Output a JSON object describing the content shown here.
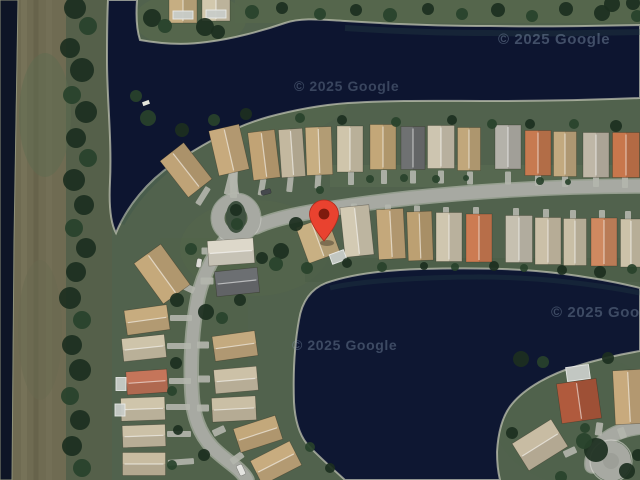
{
  "map": {
    "view_type": "satellite",
    "attribution": "© 2025 Google",
    "pin": {
      "label": "dropped-pin",
      "color": "#e9422f",
      "inner_color": "#7e1b0e",
      "x": 324,
      "y": 241
    },
    "colors": {
      "water": "#0d1530",
      "land": "#51624d",
      "road": "#a7a9a2",
      "shoreline": "#c8cbb8",
      "tree_dark": "#1c2f20",
      "tree_mid": "#28422b",
      "tree_light": "#355033",
      "bank_brown": "#6f6b52"
    }
  },
  "houses": [
    [
      186,
      170,
      30,
      46,
      -38,
      "#bfa377"
    ],
    [
      229,
      150,
      31,
      46,
      -13,
      "#c7aa7d"
    ],
    [
      264,
      155,
      27,
      48,
      -7,
      "#c1a375"
    ],
    [
      292,
      153,
      24,
      48,
      -4,
      "#c3b89f"
    ],
    [
      319,
      151,
      26,
      48,
      -2,
      "#c7ae82"
    ],
    [
      350,
      149,
      26,
      46,
      0,
      "#cfc5ab"
    ],
    [
      383,
      147,
      26,
      45,
      0,
      "#c3a778"
    ],
    [
      413,
      148,
      24,
      43,
      0,
      "#6f7172"
    ],
    [
      441,
      147,
      27,
      43,
      0,
      "#cdc5b0"
    ],
    [
      469,
      149,
      23,
      43,
      0,
      "#c1a77b"
    ],
    [
      508,
      147,
      26,
      44,
      0,
      "#b4b2aa"
    ],
    [
      538,
      153,
      26,
      45,
      0,
      "#c77a50"
    ],
    [
      565,
      154,
      23,
      45,
      0,
      "#c2a97f"
    ],
    [
      596,
      155,
      26,
      45,
      0,
      "#bfb7a7"
    ],
    [
      626,
      155,
      27,
      45,
      0,
      "#c8774c"
    ],
    [
      183,
      8,
      28,
      30,
      0,
      "#c6ae82"
    ],
    [
      216,
      7,
      28,
      28,
      0,
      "#d2c8ad"
    ],
    [
      318,
      240,
      33,
      38,
      -20,
      "#c8b083"
    ],
    [
      357,
      231,
      29,
      50,
      -6,
      "#d3cab3"
    ],
    [
      391,
      234,
      27,
      50,
      -3,
      "#c4a87b"
    ],
    [
      420,
      236,
      25,
      49,
      -2,
      "#bca072"
    ],
    [
      449,
      237,
      26,
      49,
      0,
      "#cfc6af"
    ],
    [
      479,
      238,
      26,
      48,
      0,
      "#cc7b52"
    ],
    [
      519,
      239,
      27,
      47,
      0,
      "#c6c0b0"
    ],
    [
      548,
      241,
      26,
      47,
      0,
      "#cbc0a8"
    ],
    [
      575,
      242,
      23,
      47,
      0,
      "#c9bfa6"
    ],
    [
      604,
      242,
      26,
      48,
      0,
      "#cf8960"
    ],
    [
      631,
      243,
      21,
      48,
      0,
      "#ccc2a9"
    ],
    [
      231,
      252,
      46,
      25,
      -4,
      "#ddd8ca"
    ],
    [
      237,
      282,
      43,
      25,
      -6,
      "#6c6f72"
    ],
    [
      235,
      346,
      43,
      25,
      -8,
      "#c4aa7f"
    ],
    [
      236,
      380,
      43,
      24,
      -5,
      "#ccc1a7"
    ],
    [
      234,
      409,
      44,
      24,
      -3,
      "#cabfa5"
    ],
    [
      258,
      434,
      44,
      25,
      -18,
      "#c3a87b"
    ],
    [
      276,
      463,
      44,
      27,
      -27,
      "#c8ac7f"
    ],
    [
      162,
      274,
      33,
      50,
      -36,
      "#c5a97b"
    ],
    [
      147,
      320,
      43,
      25,
      -8,
      "#c7ac7f"
    ],
    [
      144,
      348,
      43,
      23,
      -6,
      "#cec4aa"
    ],
    [
      147,
      382,
      41,
      23,
      -4,
      "#c5755a"
    ],
    [
      143,
      409,
      44,
      23,
      -2,
      "#cfc5ab"
    ],
    [
      144,
      436,
      43,
      22,
      -2,
      "#ccc1a7"
    ],
    [
      144,
      464,
      43,
      23,
      0,
      "#c8bca1"
    ],
    [
      579,
      401,
      40,
      40,
      -8,
      "#b05a3d"
    ],
    [
      629,
      397,
      30,
      54,
      -3,
      "#c8aa7d"
    ],
    [
      540,
      445,
      46,
      32,
      -32,
      "#c8bca3"
    ]
  ],
  "pools": [
    [
      183,
      15,
      20,
      8,
      0
    ],
    [
      216,
      14,
      20,
      8,
      0
    ],
    [
      578,
      373,
      23,
      14,
      -8
    ],
    [
      338,
      257,
      15,
      10,
      -20
    ],
    [
      121,
      384,
      10,
      13,
      0
    ],
    [
      120,
      410,
      10,
      12,
      0
    ]
  ],
  "driveways": [
    [
      351,
      178,
      6,
      14,
      0
    ],
    [
      384,
      177,
      6,
      14,
      0
    ],
    [
      413,
      177,
      6,
      13,
      0
    ],
    [
      441,
      177,
      6,
      13,
      0
    ],
    [
      470,
      178,
      6,
      13,
      0
    ],
    [
      508,
      178,
      6,
      13,
      0
    ],
    [
      538,
      180,
      6,
      12,
      0
    ],
    [
      565,
      181,
      6,
      12,
      0
    ],
    [
      596,
      181,
      6,
      12,
      0
    ],
    [
      625,
      182,
      6,
      12,
      0
    ],
    [
      318,
      181,
      6,
      15,
      4
    ],
    [
      290,
      184,
      6,
      16,
      6
    ],
    [
      262,
      187,
      6,
      17,
      10
    ],
    [
      230,
      183,
      7,
      24,
      14
    ],
    [
      203,
      196,
      6,
      20,
      32
    ],
    [
      234,
      182,
      7,
      32,
      2
    ],
    [
      354,
      209,
      6,
      11,
      0
    ],
    [
      388,
      210,
      6,
      11,
      0
    ],
    [
      417,
      211,
      6,
      11,
      0
    ],
    [
      446,
      212,
      6,
      10,
      0
    ],
    [
      476,
      212,
      6,
      10,
      0
    ],
    [
      516,
      213,
      6,
      10,
      0
    ],
    [
      546,
      214,
      6,
      10,
      0
    ],
    [
      573,
      215,
      6,
      10,
      0
    ],
    [
      602,
      215,
      6,
      10,
      0
    ],
    [
      628,
      216,
      6,
      10,
      0
    ],
    [
      317,
      212,
      7,
      13,
      -12
    ],
    [
      208,
      251,
      13,
      7,
      0
    ],
    [
      207,
      281,
      13,
      7,
      0
    ],
    [
      203,
      345,
      12,
      7,
      0
    ],
    [
      204,
      379,
      12,
      7,
      0
    ],
    [
      203,
      408,
      12,
      7,
      0
    ],
    [
      219,
      431,
      13,
      7,
      -25
    ],
    [
      237,
      458,
      14,
      7,
      -35
    ],
    [
      181,
      318,
      22,
      6,
      0
    ],
    [
      179,
      346,
      24,
      6,
      0
    ],
    [
      180,
      381,
      22,
      6,
      0
    ],
    [
      178,
      407,
      24,
      6,
      0
    ],
    [
      179,
      434,
      24,
      6,
      0
    ],
    [
      181,
      462,
      26,
      6,
      -4
    ],
    [
      186,
      287,
      18,
      7,
      25
    ],
    [
      599,
      429,
      7,
      13,
      8
    ],
    [
      570,
      452,
      13,
      7,
      -25
    ],
    [
      622,
      433,
      7,
      11,
      -20
    ]
  ],
  "trees": [
    [
      75,
      8,
      11,
      0
    ],
    [
      88,
      26,
      9,
      1
    ],
    [
      70,
      48,
      10,
      0
    ],
    [
      82,
      70,
      12,
      0
    ],
    [
      72,
      95,
      9,
      1
    ],
    [
      86,
      112,
      11,
      0
    ],
    [
      76,
      138,
      10,
      0
    ],
    [
      88,
      158,
      9,
      1
    ],
    [
      74,
      180,
      11,
      0
    ],
    [
      84,
      205,
      10,
      0
    ],
    [
      74,
      228,
      9,
      1
    ],
    [
      86,
      248,
      10,
      0
    ],
    [
      76,
      272,
      10,
      0
    ],
    [
      70,
      298,
      11,
      0
    ],
    [
      82,
      320,
      9,
      1
    ],
    [
      72,
      345,
      10,
      0
    ],
    [
      80,
      370,
      11,
      0
    ],
    [
      70,
      396,
      9,
      1
    ],
    [
      80,
      420,
      10,
      0
    ],
    [
      72,
      446,
      10,
      0
    ],
    [
      82,
      468,
      9,
      1
    ],
    [
      152,
      18,
      9,
      0
    ],
    [
      165,
      26,
      7,
      1
    ],
    [
      205,
      27,
      9,
      0
    ],
    [
      218,
      32,
      7,
      0
    ],
    [
      252,
      12,
      7,
      1
    ],
    [
      282,
      8,
      6,
      0
    ],
    [
      320,
      14,
      6,
      1
    ],
    [
      356,
      10,
      6,
      0
    ],
    [
      390,
      15,
      7,
      1
    ],
    [
      428,
      9,
      6,
      0
    ],
    [
      462,
      14,
      6,
      1
    ],
    [
      498,
      10,
      7,
      0
    ],
    [
      532,
      16,
      6,
      1
    ],
    [
      566,
      9,
      7,
      0
    ],
    [
      602,
      13,
      8,
      0
    ],
    [
      612,
      4,
      8,
      0
    ],
    [
      633,
      3,
      7,
      0
    ],
    [
      637,
      16,
      6,
      1
    ],
    [
      148,
      118,
      8,
      1
    ],
    [
      182,
      130,
      7,
      0
    ],
    [
      214,
      120,
      6,
      1
    ],
    [
      246,
      114,
      6,
      0
    ],
    [
      300,
      118,
      5,
      1
    ],
    [
      342,
      120,
      5,
      0
    ],
    [
      396,
      122,
      5,
      1
    ],
    [
      452,
      120,
      5,
      0
    ],
    [
      492,
      124,
      5,
      1
    ],
    [
      530,
      124,
      5,
      0
    ],
    [
      574,
      124,
      5,
      1
    ],
    [
      616,
      126,
      6,
      0
    ],
    [
      136,
      96,
      6,
      1
    ],
    [
      370,
      179,
      4,
      1
    ],
    [
      404,
      178,
      4,
      1
    ],
    [
      436,
      179,
      4,
      1
    ],
    [
      466,
      178,
      3,
      1
    ],
    [
      540,
      181,
      4,
      1
    ],
    [
      568,
      182,
      3,
      1
    ],
    [
      320,
      190,
      4,
      1
    ],
    [
      236,
      210,
      6,
      0
    ],
    [
      237,
      224,
      6,
      1
    ],
    [
      296,
      224,
      7,
      0
    ],
    [
      281,
      251,
      8,
      0
    ],
    [
      307,
      268,
      6,
      1
    ],
    [
      347,
      263,
      5,
      0
    ],
    [
      382,
      267,
      5,
      1
    ],
    [
      424,
      266,
      4,
      0
    ],
    [
      455,
      267,
      4,
      1
    ],
    [
      494,
      266,
      5,
      0
    ],
    [
      524,
      268,
      4,
      1
    ],
    [
      562,
      270,
      5,
      0
    ],
    [
      600,
      272,
      6,
      0
    ],
    [
      632,
      269,
      5,
      1
    ],
    [
      191,
      249,
      6,
      1
    ],
    [
      177,
      300,
      7,
      0
    ],
    [
      206,
      312,
      8,
      0
    ],
    [
      222,
      318,
      6,
      1
    ],
    [
      176,
      363,
      6,
      0
    ],
    [
      172,
      391,
      5,
      1
    ],
    [
      178,
      430,
      5,
      0
    ],
    [
      204,
      455,
      6,
      0
    ],
    [
      172,
      465,
      5,
      1
    ],
    [
      240,
      300,
      6,
      0
    ],
    [
      262,
      258,
      6,
      0
    ],
    [
      276,
      264,
      7,
      1
    ],
    [
      521,
      359,
      8,
      0
    ],
    [
      543,
      362,
      6,
      1
    ],
    [
      608,
      358,
      6,
      0
    ],
    [
      585,
      428,
      5,
      1
    ],
    [
      512,
      433,
      6,
      0
    ],
    [
      596,
      450,
      12,
      0
    ],
    [
      584,
      441,
      8,
      1
    ],
    [
      627,
      471,
      8,
      0
    ],
    [
      561,
      477,
      6,
      1
    ],
    [
      638,
      455,
      6,
      0
    ],
    [
      310,
      447,
      5,
      1
    ],
    [
      330,
      468,
      5,
      0
    ]
  ],
  "cars": [
    [
      266,
      192,
      5,
      10,
      75,
      "#45484d"
    ],
    [
      241,
      470,
      6,
      11,
      -25,
      "#e4e4e0"
    ],
    [
      199,
      263,
      5,
      9,
      10,
      "#dddcd6"
    ]
  ],
  "docks": [
    [
      146,
      103,
      7,
      4,
      -20
    ]
  ]
}
